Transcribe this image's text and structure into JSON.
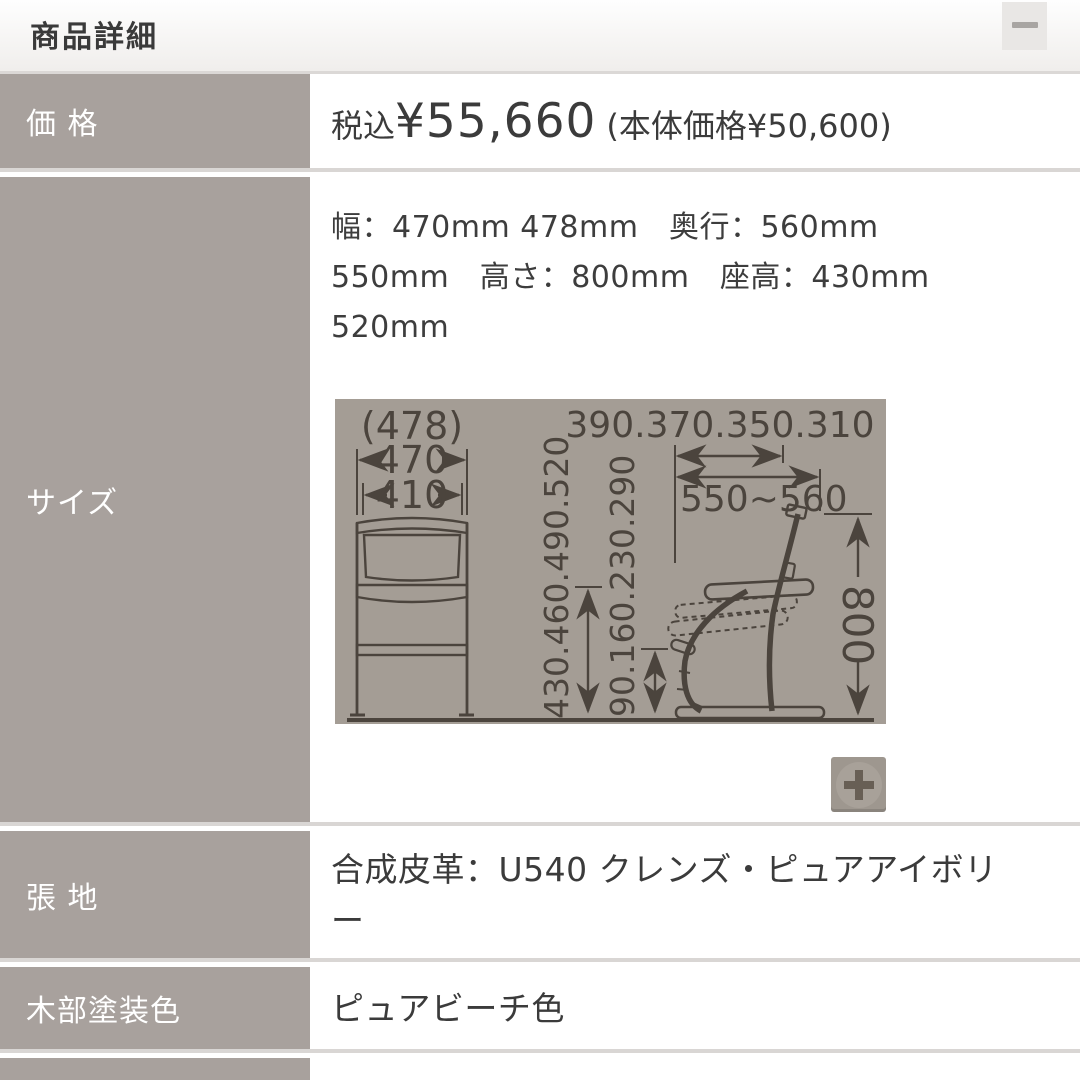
{
  "header": {
    "title": "商品詳細"
  },
  "icons": {
    "minimize": "minus",
    "zoom_in": "plus"
  },
  "rows": {
    "price": {
      "label": "価 格",
      "tax_prefix": "税込",
      "amount": "¥55,660",
      "base_note": "(本体価格¥50,600)"
    },
    "size": {
      "label": "サイズ",
      "lines": [
        "幅：470mm 478mm　奥行：560mm",
        "550mm　高さ：800mm　座高：430mm",
        "520mm"
      ]
    },
    "upholstery": {
      "label": "張 地",
      "value": "合成皮革：U540 クレンズ・ピュアアイボリー"
    },
    "wood_color": {
      "label": "木部塗装色",
      "value": "ピュアビーチ色"
    }
  },
  "diagram": {
    "front_overall_width": "(478)",
    "front_width": "470",
    "front_inner_width": "410",
    "seat_height_options": "430.460.490.520",
    "footrest_height_options": "90.160.230.290",
    "seat_depth_options": "390.370.350.310",
    "depth_range": "550~560",
    "total_height": "800"
  },
  "colors": {
    "label_bg": "#a8a19d",
    "diagram_bg": "#a49d95",
    "diagram_line": "#4b443d",
    "divider": "#d9d6d4",
    "text": "#3b3b3b"
  }
}
